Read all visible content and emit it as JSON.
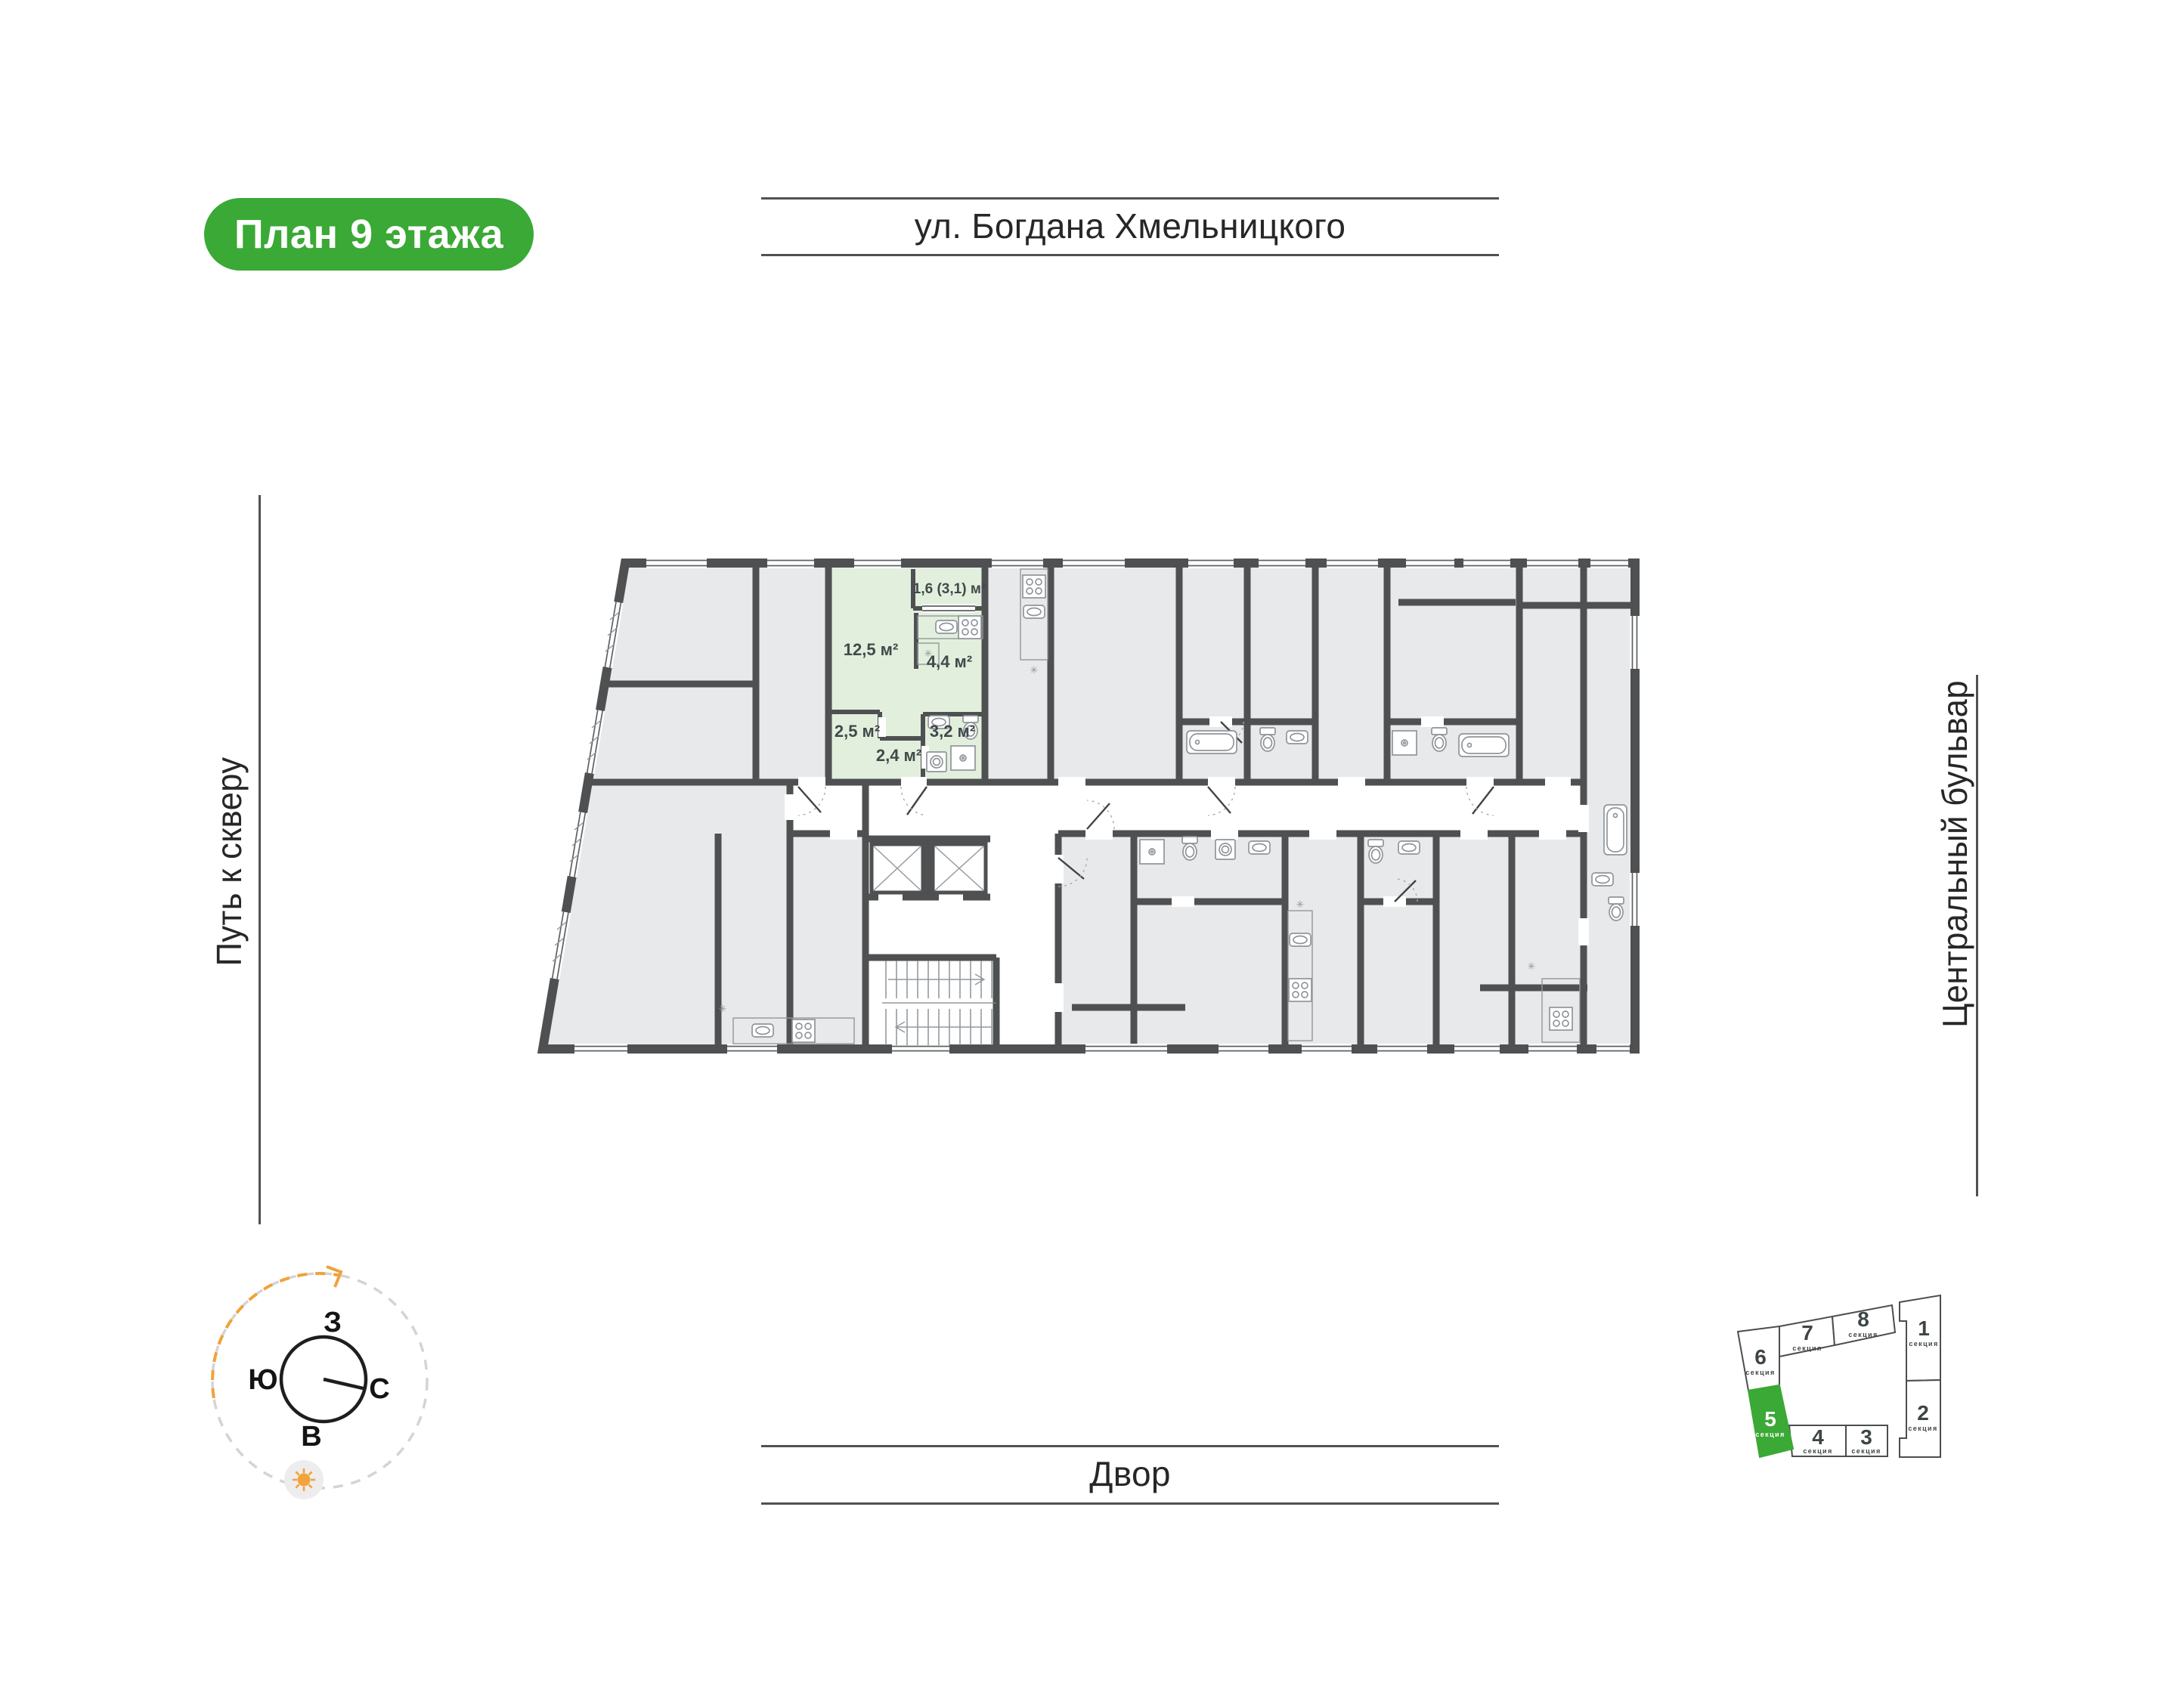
{
  "badge": {
    "label": "План 9 этажа",
    "bg": "#3aa935",
    "text_color": "#ffffff"
  },
  "streets": {
    "top": "ул. Богдана Хмельницкого",
    "bottom": "Двор",
    "left": "Путь к скверу",
    "right": "Центральный бульвар"
  },
  "plan": {
    "highlight_color": "#e2efdc",
    "room_color": "#e8e9ea",
    "wall_color": "#4e5052",
    "rooms": {
      "balcony": "1,6 (3,1) м²",
      "living": "12,5 м²",
      "kitchen": "4,4 м²",
      "hall": "2,5 м²",
      "bathroom": "3,2 м²",
      "corridor": "2,4 м²"
    },
    "fridge_symbol": "✳"
  },
  "compass": {
    "west": "З",
    "south": "Ю",
    "north": "С",
    "east": "В",
    "arc_color": "#f0a23b"
  },
  "sections": {
    "label": "секция",
    "active": "5",
    "active_color": "#3aa935",
    "items": [
      {
        "num": "6"
      },
      {
        "num": "7"
      },
      {
        "num": "8"
      },
      {
        "num": "1"
      },
      {
        "num": "2"
      },
      {
        "num": "4"
      },
      {
        "num": "3"
      },
      {
        "num": "5"
      }
    ]
  }
}
